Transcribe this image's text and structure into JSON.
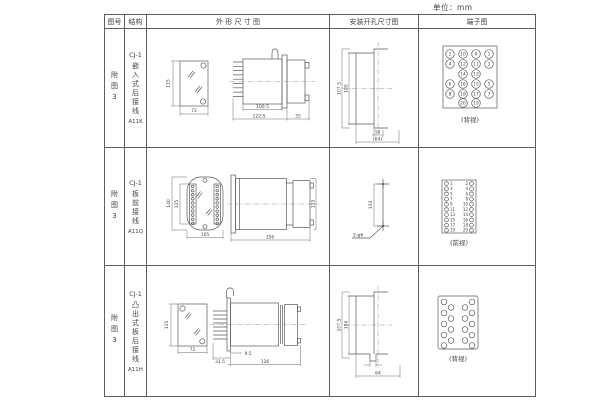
{
  "units_label": "单位：mm",
  "table": {
    "headers": {
      "figure": "图号",
      "structure": "结构",
      "outline": "外 形 尺 寸 图",
      "mounting": "安装开孔尺寸图",
      "terminal": "端子图"
    }
  },
  "rows": [
    {
      "figure_no": "附图3",
      "structure": {
        "model": "CJ-1",
        "type": "嵌入式后接线",
        "code": "A11K"
      },
      "outline": {
        "front_h": "115",
        "front_w": "72",
        "d_body": "100.5",
        "d_total": "122.5",
        "d_rear": "35"
      },
      "mounting": {
        "v_outer": "107.5",
        "v_inner": "105",
        "h_inner": "16",
        "h_outer": "(64)"
      },
      "terminal": {
        "caption": "(背视)",
        "numbers": [
          "2",
          "10",
          "9",
          "1",
          "4",
          "12",
          "11",
          "3",
          "14",
          "13",
          "6",
          "16",
          "15",
          "5",
          "8",
          "18",
          "17",
          "7",
          "20",
          "19"
        ]
      }
    },
    {
      "figure_no": "附图3",
      "structure": {
        "model": "CJ-1",
        "type": "板前接线",
        "code": "A11Q"
      },
      "outline": {
        "front_h_outer": "140",
        "front_h_inner": "125",
        "front_w": "105",
        "side_len": "156",
        "side_h": "115"
      },
      "mounting": {
        "pitch": "133",
        "holes": "2-φ6"
      },
      "terminal": {
        "caption": "(前视)",
        "left_numbers": [
          "1",
          "3",
          "5",
          "7",
          "9",
          "11",
          "13",
          "15",
          "17",
          "19"
        ],
        "right_numbers": [
          "2",
          "4",
          "6",
          "8",
          "10",
          "12",
          "14",
          "16",
          "18",
          "20"
        ]
      }
    },
    {
      "figure_no": "附图3",
      "structure": {
        "model": "CJ-1",
        "type": "凸出式板后接线",
        "code": "A11H"
      },
      "outline": {
        "front_h": "115",
        "front_w": "72",
        "d_pins": "31.5",
        "d_plate": "9.5",
        "d_body": "126"
      },
      "mounting": {
        "v_outer": "107.5",
        "v_inner": "104",
        "h_outer": "64"
      },
      "terminal": {
        "caption": "(背视)"
      }
    }
  ]
}
